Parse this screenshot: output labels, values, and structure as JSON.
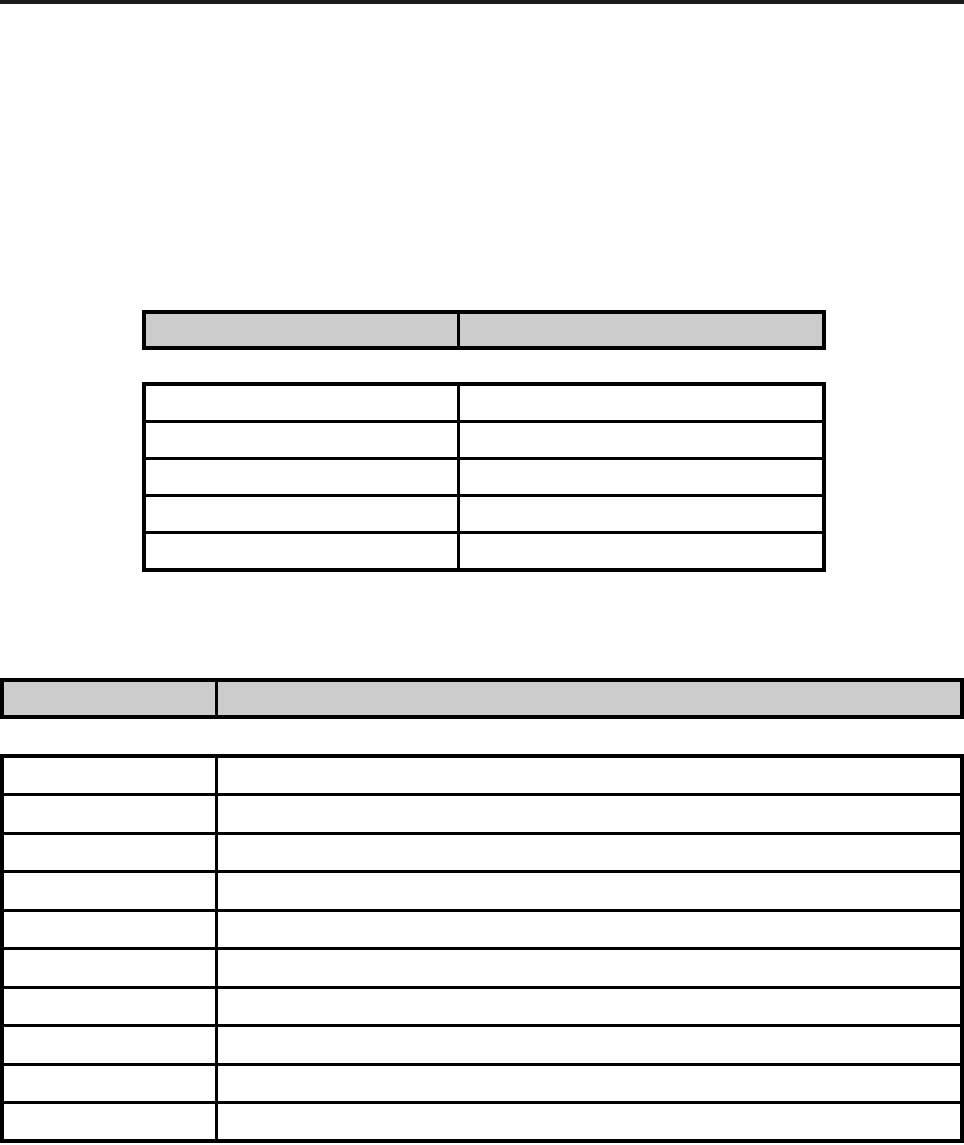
{
  "page": {
    "top_rule_color": "#1a1a1a"
  },
  "colors": {
    "header_fill": "#cccccc",
    "border": "#000000",
    "background": "#ffffff"
  },
  "tables": {
    "upper_header": {
      "shaded": true,
      "rows": 1,
      "cols": 2,
      "cells": [
        [
          "",
          ""
        ]
      ]
    },
    "upper_body": {
      "shaded": false,
      "rows": 5,
      "cols": 2,
      "cells": [
        [
          "",
          ""
        ],
        [
          "",
          ""
        ],
        [
          "",
          ""
        ],
        [
          "",
          ""
        ],
        [
          "",
          ""
        ]
      ]
    },
    "lower_header": {
      "shaded": true,
      "rows": 1,
      "cols": 2,
      "cells": [
        [
          "",
          ""
        ]
      ]
    },
    "lower_body": {
      "shaded": false,
      "rows": 10,
      "cols": 2,
      "cells": [
        [
          "",
          ""
        ],
        [
          "",
          ""
        ],
        [
          "",
          ""
        ],
        [
          "",
          ""
        ],
        [
          "",
          ""
        ],
        [
          "",
          ""
        ],
        [
          "",
          ""
        ],
        [
          "",
          ""
        ],
        [
          "",
          ""
        ],
        [
          "",
          ""
        ]
      ]
    }
  }
}
